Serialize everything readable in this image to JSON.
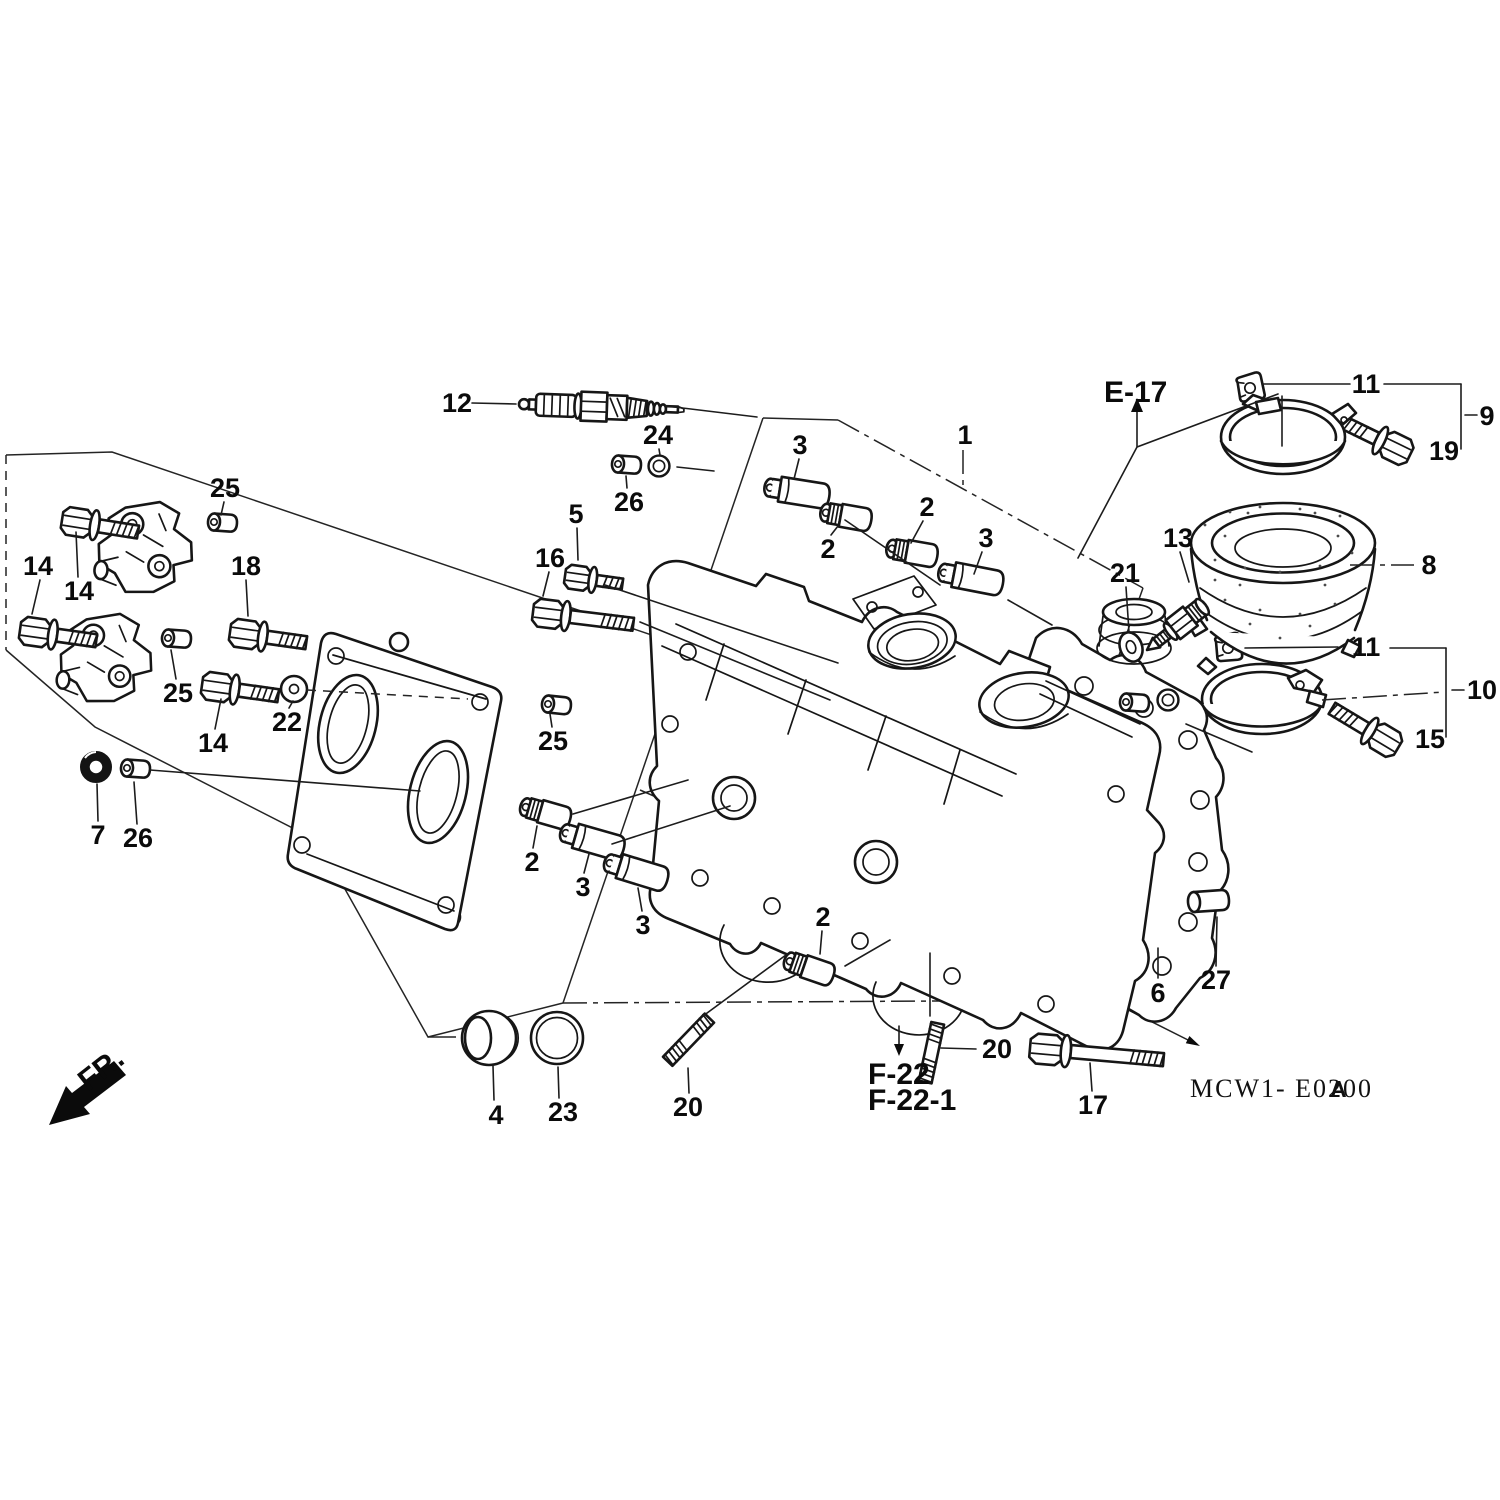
{
  "diagram": {
    "section_ref": "E-17",
    "subsection_ref_1": "F-22",
    "subsection_ref_2": "F-22-1",
    "direction_label": "FR.",
    "code": "MCW1- E0200",
    "code_suffix": "A"
  },
  "callouts": [
    {
      "text": "12",
      "x": 457,
      "y": 403
    },
    {
      "text": "24",
      "x": 658,
      "y": 435
    },
    {
      "text": "26",
      "x": 629,
      "y": 502
    },
    {
      "text": "3",
      "x": 800,
      "y": 445
    },
    {
      "text": "1",
      "x": 965,
      "y": 435
    },
    {
      "text": "2",
      "x": 927,
      "y": 507
    },
    {
      "text": "3",
      "x": 986,
      "y": 538
    },
    {
      "text": "2",
      "x": 828,
      "y": 549
    },
    {
      "text": "5",
      "x": 576,
      "y": 514
    },
    {
      "text": "16",
      "x": 550,
      "y": 558
    },
    {
      "text": "25",
      "x": 225,
      "y": 488
    },
    {
      "text": "14",
      "x": 38,
      "y": 566
    },
    {
      "text": "14",
      "x": 79,
      "y": 591
    },
    {
      "text": "18",
      "x": 246,
      "y": 566
    },
    {
      "text": "25",
      "x": 178,
      "y": 693
    },
    {
      "text": "14",
      "x": 213,
      "y": 743
    },
    {
      "text": "22",
      "x": 287,
      "y": 722
    },
    {
      "text": "25",
      "x": 553,
      "y": 741
    },
    {
      "text": "7",
      "x": 98,
      "y": 835
    },
    {
      "text": "26",
      "x": 138,
      "y": 838
    },
    {
      "text": "2",
      "x": 532,
      "y": 862
    },
    {
      "text": "3",
      "x": 583,
      "y": 887
    },
    {
      "text": "3",
      "x": 643,
      "y": 925
    },
    {
      "text": "2",
      "x": 823,
      "y": 917
    },
    {
      "text": "4",
      "x": 496,
      "y": 1115
    },
    {
      "text": "23",
      "x": 563,
      "y": 1112
    },
    {
      "text": "20",
      "x": 688,
      "y": 1107
    },
    {
      "text": "20",
      "x": 997,
      "y": 1049
    },
    {
      "text": "17",
      "x": 1093,
      "y": 1105
    },
    {
      "text": "6",
      "x": 1158,
      "y": 993
    },
    {
      "text": "27",
      "x": 1216,
      "y": 980
    },
    {
      "text": "13",
      "x": 1178,
      "y": 538
    },
    {
      "text": "21",
      "x": 1125,
      "y": 573
    },
    {
      "text": "8",
      "x": 1429,
      "y": 565
    },
    {
      "text": "9",
      "x": 1487,
      "y": 416
    },
    {
      "text": "19",
      "x": 1444,
      "y": 451
    },
    {
      "text": "11",
      "x": 1366,
      "y": 384
    },
    {
      "text": "11",
      "x": 1366,
      "y": 647
    },
    {
      "text": "10",
      "x": 1482,
      "y": 690
    },
    {
      "text": "15",
      "x": 1430,
      "y": 739
    }
  ]
}
